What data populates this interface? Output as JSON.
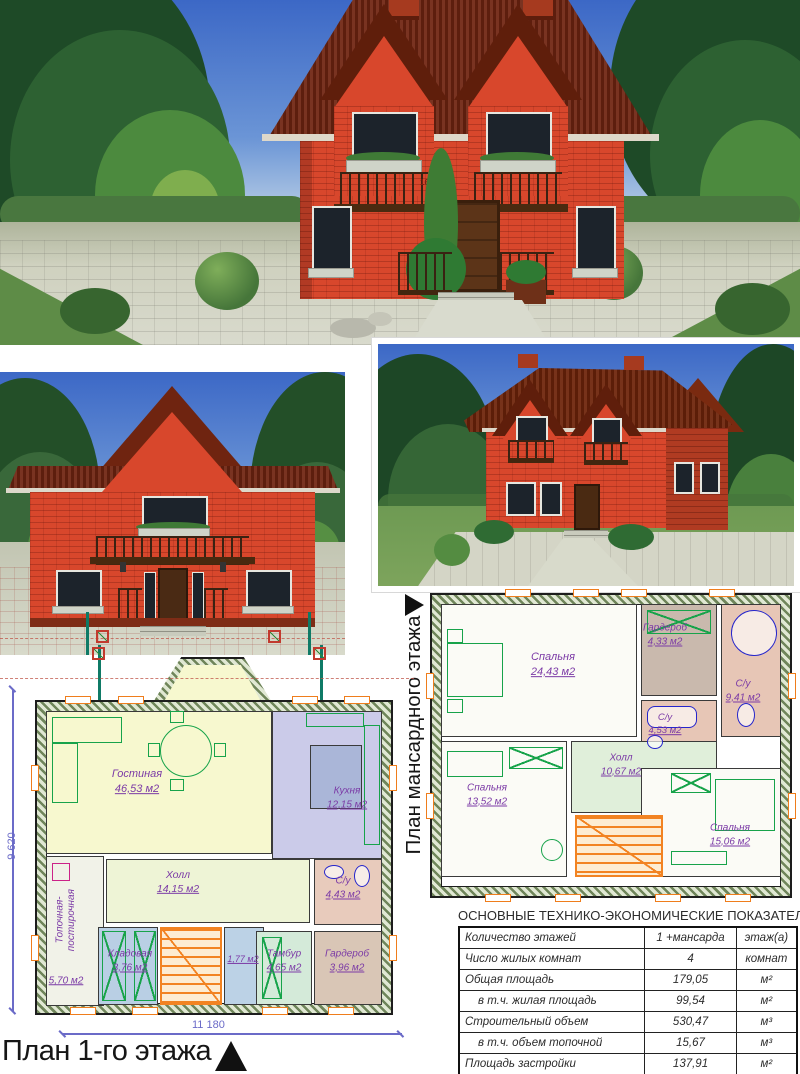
{
  "photos": {
    "main": {
      "sign": "166-01"
    }
  },
  "plans": {
    "first_floor": {
      "title": "План 1-го этажа",
      "width_dim": "11 180",
      "height_dim": "9 620",
      "rooms": [
        {
          "name": "Гостиная",
          "area": "46,53 м2"
        },
        {
          "name": "Кухня",
          "area": "12,15 м2"
        },
        {
          "name": "Холл",
          "area": "14,15 м2"
        },
        {
          "name": "С/у",
          "area": "4,43 м2"
        },
        {
          "name": "Топочная-постирочная",
          "area": "5,70 м2"
        },
        {
          "name": "Кладовая",
          "area": "3,76 м2"
        },
        {
          "name": "",
          "area": "1,77 м2"
        },
        {
          "name": "Тамбур",
          "area": "4,65 м2"
        },
        {
          "name": "Гардероб",
          "area": "3,96 м2"
        }
      ]
    },
    "attic": {
      "title": "План мансардного этажа",
      "rooms": [
        {
          "name": "Спальня",
          "area": "24,43 м2"
        },
        {
          "name": "Гардероб",
          "area": "4,33 м2"
        },
        {
          "name": "С/у",
          "area": "9,41 м2"
        },
        {
          "name": "С/у",
          "area": "4,53 м2"
        },
        {
          "name": "Холл",
          "area": "10,67 м2"
        },
        {
          "name": "Спальня",
          "area": "13,52 м2"
        },
        {
          "name": "Спальня",
          "area": "15,06 м2"
        }
      ]
    }
  },
  "table": {
    "title": "ОСНОВНЫЕ ТЕХНИКО-ЭКОНОМИЧЕСКИЕ ПОКАЗАТЕЛИ",
    "rows": [
      {
        "label": "Количество этажей",
        "value": "1 +мансарда",
        "unit": "этаж(а)",
        "indent": false
      },
      {
        "label": "Число жилых комнат",
        "value": "4",
        "unit": "комнат",
        "indent": false
      },
      {
        "label": "Общая площадь",
        "value": "179,05",
        "unit": "м²",
        "indent": false
      },
      {
        "label": "в т.ч. жилая площадь",
        "value": "99,54",
        "unit": "м²",
        "indent": true
      },
      {
        "label": "Строительный объем",
        "value": "530,47",
        "unit": "м³",
        "indent": false
      },
      {
        "label": "в т.ч. объем топочной",
        "value": "15,67",
        "unit": "м³",
        "indent": true
      },
      {
        "label": "Площадь застройки",
        "value": "137,91",
        "unit": "м²",
        "indent": false
      }
    ]
  },
  "colors": {
    "brick": "#dc4a2e",
    "roof": "#6f2410",
    "label_purple": "#7b3aa6",
    "stairs_orange": "#ef7d1c",
    "furniture_green": "#17a34a",
    "fixture_blue": "#2525cc",
    "dimension_blue": "#6b6bc8"
  }
}
